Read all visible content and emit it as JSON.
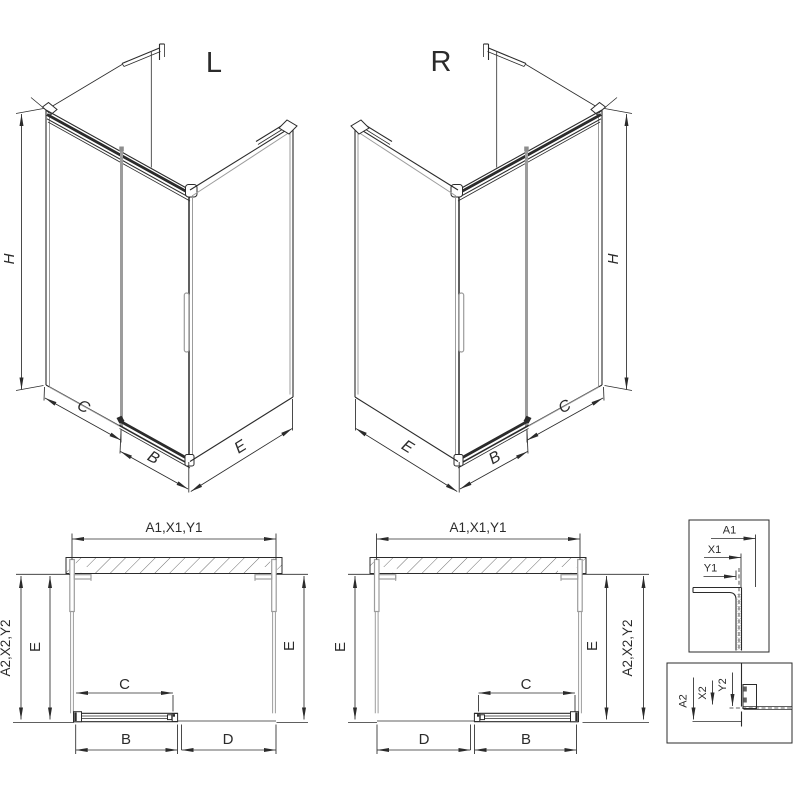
{
  "colors": {
    "line": "#2b2b2b",
    "glass": "#9c9c9c",
    "hatch": "#4a4a4a",
    "background": "#ffffff"
  },
  "iso_left": {
    "title": "L",
    "dim_height": "H",
    "dim_fixed": "C",
    "dim_door": "B",
    "dim_side": "E"
  },
  "iso_right": {
    "title": "R",
    "dim_height": "H",
    "dim_fixed": "C",
    "dim_door": "B",
    "dim_side": "E"
  },
  "plan_left": {
    "dim_top": "A1,X1,Y1",
    "dim_outer": "A2,X2,Y2",
    "dim_side_left": "E",
    "dim_side_right": "E",
    "dim_door": "C",
    "dim_bottom_left": "B",
    "dim_bottom_right": "D"
  },
  "plan_right": {
    "dim_top": "A1,X1,Y1",
    "dim_outer": "A2,X2,Y2",
    "dim_side_left": "E",
    "dim_side_right": "E",
    "dim_door": "C",
    "dim_bottom_left": "D",
    "dim_bottom_right": "B"
  },
  "detail_top": {
    "dim_a": "A1",
    "dim_x": "X1",
    "dim_y": "Y1"
  },
  "detail_bottom": {
    "dim_a": "A2",
    "dim_x": "X2",
    "dim_y": "Y2"
  }
}
